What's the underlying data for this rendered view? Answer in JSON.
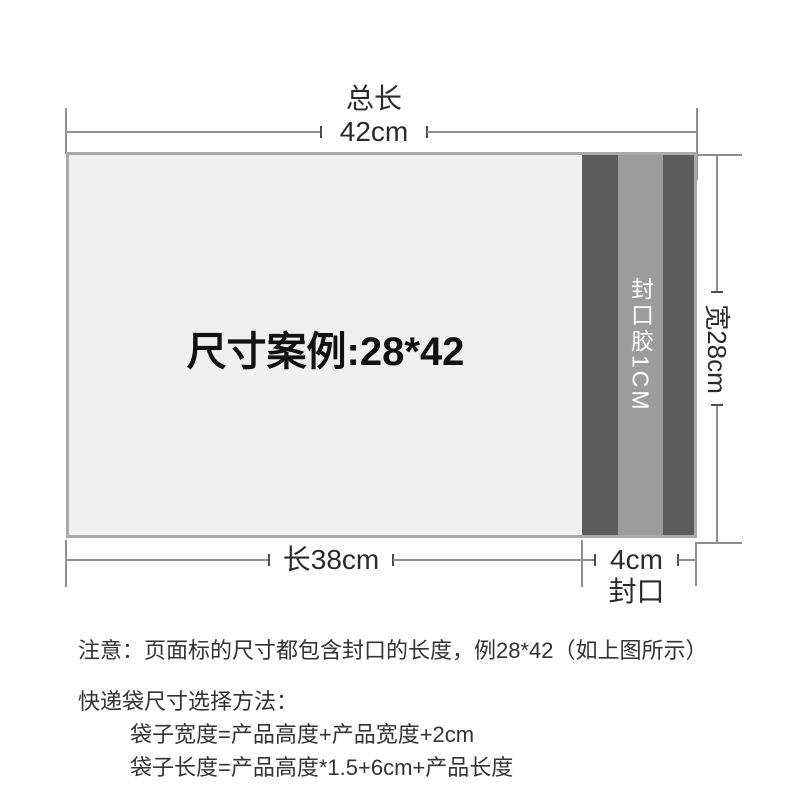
{
  "diagram": {
    "total_length_label": "总长",
    "total_length_value": "42cm",
    "bag_example_text": "尺寸案例:28*42",
    "seal_tape_text": "封口胶1CM",
    "width_dim_text": "宽28cm",
    "body_length_text": "长38cm",
    "seal_length_text": "4cm",
    "seal_label": "封口"
  },
  "notes": {
    "notice": "注意：页面标的尺寸都包含封口的长度，例28*42（如上图所示）",
    "method_title": "快递袋尺寸选择方法：",
    "formula_width": "袋子宽度=产品高度+产品宽度+2cm",
    "formula_length": "袋子长度=产品高度*1.5+6cm+产品长度"
  },
  "colors": {
    "bag_fill": "#f0f0f0",
    "bag_border": "#a9a9a9",
    "seal_band_dark": "#5c5c5c",
    "seal_band_mid": "#9c9c9c",
    "dimension_line": "#8f8f8f",
    "text": "#333333",
    "seal_text": "#ffffff"
  }
}
